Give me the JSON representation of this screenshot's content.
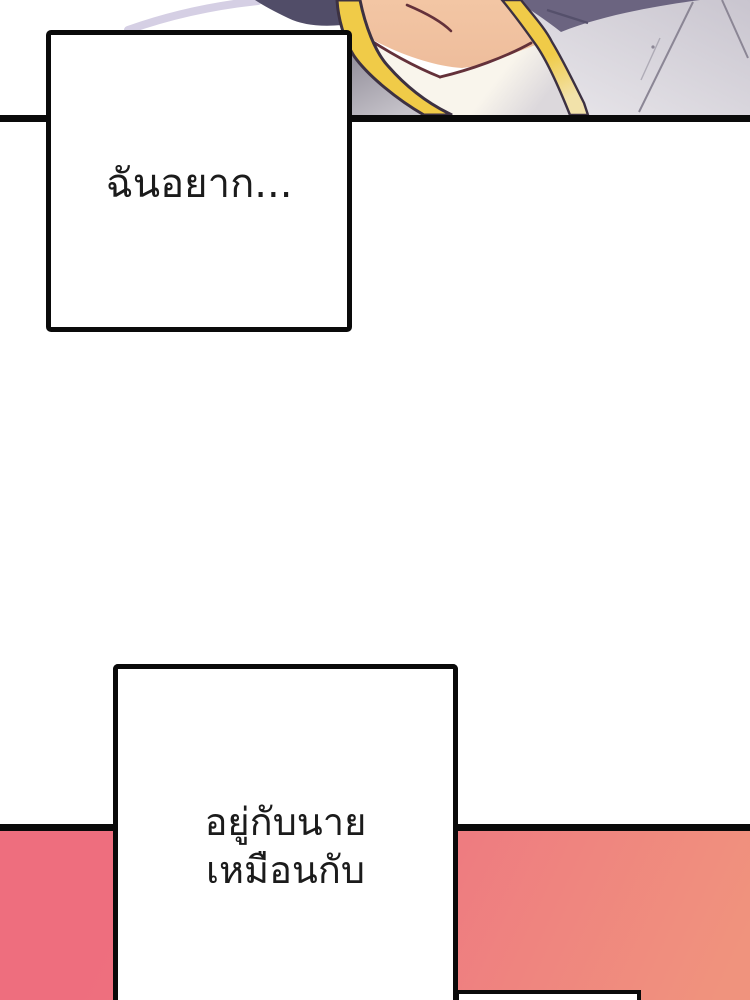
{
  "page": {
    "width": 750,
    "height": 1000,
    "background": "#ffffff"
  },
  "bubbles": [
    {
      "text": "ฉันอยาก..."
    },
    {
      "lines": [
        "อยู่กับนาย",
        "เหมือนกับ"
      ]
    }
  ],
  "palette": {
    "ink": "#0a0a0a",
    "text": "#1b1b1b",
    "pink-a": "#ee6e7e",
    "pink-b": "#f0937d",
    "gold": "#f0cb48",
    "gold-pale": "#f2e2aa",
    "gold-line": "#3c3142",
    "skin": "#f3c6a4",
    "skin-line": "#64313a",
    "cream": "#f9f5ec",
    "cream-shade": "#dcd8dc",
    "navy-a": "#514d68",
    "navy-b": "#6b6480",
    "fabric": "#c9c5cf",
    "fabric-light": "#eae8ec",
    "crease": "#8b8695",
    "shadow-a": "#8f8b97",
    "shadow-b": "#c6c3ca",
    "lavender": "#d5cfe4"
  }
}
